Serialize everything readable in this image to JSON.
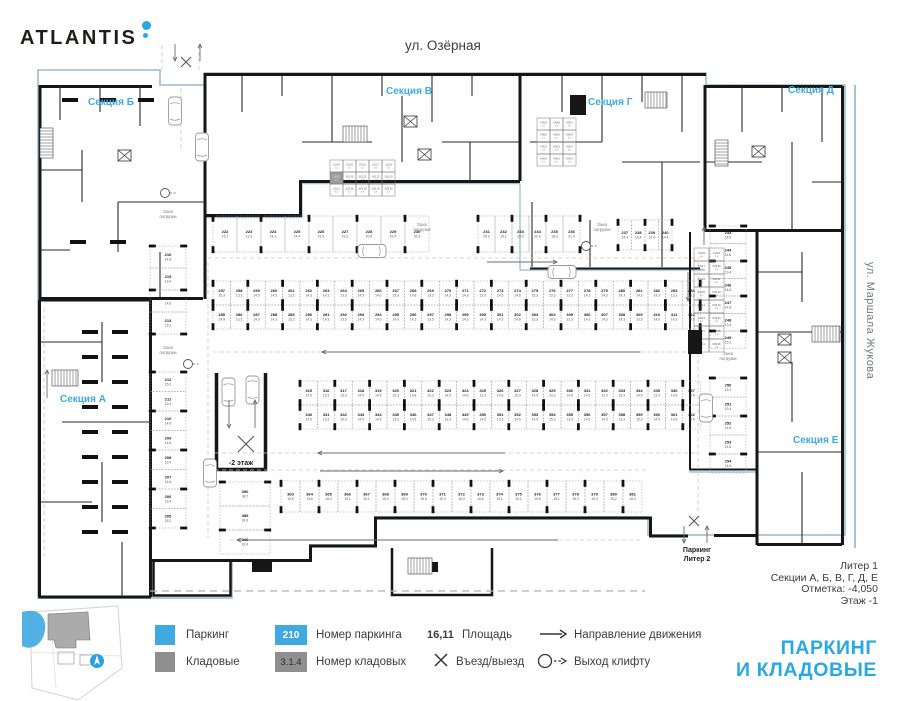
{
  "logo": {
    "text": "ATLANTIS"
  },
  "streets": {
    "top": "ул. Озёрная",
    "right": "ул. Маршала Жукова"
  },
  "sections": {
    "a": "Секция А",
    "b": "Секция Б",
    "v": "Секция В",
    "g": "Секция Г",
    "d": "Секция Д",
    "e": "Секция Е"
  },
  "info": {
    "lines": [
      "Литер 1",
      "Секции А, Б, В, Г, Д, Е",
      "Отметка: -4,050",
      "Этаж -1"
    ]
  },
  "main_title": {
    "line1": "ПАРКИНГ",
    "line2": "И КЛАДОВЫЕ"
  },
  "legend": {
    "parking": "Паркинг",
    "storage": "Кладовые",
    "pnum_value": "210",
    "pnum_label": "Номер паркинга",
    "snum_value": "3.1.4",
    "snum_label": "Номер кладовых",
    "area_value": "16,11",
    "area_label": "Площадь",
    "entry_label": "Въезд/выезд",
    "direction_label": "Направление движения",
    "lift_label": "Выход клифту"
  },
  "colors": {
    "accent": "#29a8e4",
    "legend_blue": "#3fa9e0",
    "legend_gray": "#8f8f8f",
    "wall": "#161616",
    "boundary_blue": "#a7c2d6"
  },
  "plan": {
    "zone_label": "Зона погрузки",
    "ramp_label": "-2 этаж",
    "exit2_lines": [
      "Паркинг",
      "Литер 2"
    ],
    "bands": [
      {
        "x": 213,
        "y": 216,
        "w": 24,
        "h": 36,
        "nums": [
          "222",
          "223",
          "224",
          "225",
          "226",
          "227",
          "228",
          "229",
          "230"
        ],
        "areas": [
          "15.1",
          "13.3",
          "14.1",
          "14.4",
          "21.9",
          "21.0",
          "20.6",
          "22.4",
          "32.3"
        ]
      },
      {
        "x": 478,
        "y": 216,
        "w": 17,
        "h": 36,
        "nums": [
          "231",
          "232",
          "233",
          "234",
          "235",
          "236"
        ],
        "areas": [
          "25.2",
          "19.1",
          "19.0",
          "20.0",
          "18.3",
          "21.4"
        ]
      },
      {
        "x": 618,
        "y": 220,
        "w": 13.5,
        "h": 30,
        "nums": [
          "237",
          "238",
          "239",
          "240"
        ],
        "areas": [
          "14.4",
          "14.4",
          "14.4",
          "14.4"
        ]
      },
      {
        "x": 213,
        "y": 281,
        "w": 17.4,
        "h": 24,
        "nums": [
          "257",
          "258",
          "259",
          "260",
          "261",
          "262",
          "263",
          "264",
          "265",
          "266",
          "267",
          "268",
          "269",
          "270",
          "271",
          "272",
          "273",
          "274",
          "275",
          "276",
          "277",
          "278",
          "279",
          "280",
          "281",
          "282",
          "283",
          "284"
        ],
        "areas": [
          "15.3",
          "13.3",
          "14.5",
          "14.5",
          "13.3",
          "14.3",
          "14.3",
          "13.3",
          "14.5",
          "14.0",
          "15.3",
          "14.8",
          "13.3",
          "14.3",
          "14.3",
          "13.3",
          "14.5",
          "14.5",
          "15.3",
          "13.3",
          "13.3",
          "14.3",
          "14.3",
          "14.3",
          "14.3",
          "14.3",
          "13.3",
          "15.3"
        ]
      },
      {
        "x": 213,
        "y": 305,
        "w": 17.4,
        "h": 24,
        "nums": [
          "285",
          "286",
          "287",
          "288",
          "289",
          "290",
          "291",
          "292",
          "293",
          "294",
          "295",
          "296",
          "297",
          "298",
          "299",
          "300",
          "301",
          "302",
          "303",
          "304",
          "305",
          "306",
          "307",
          "308",
          "309",
          "310",
          "311",
          "312"
        ],
        "areas": [
          "14.9",
          "13.3",
          "14.3",
          "14.3",
          "13.3",
          "14.3",
          "14.3",
          "13.3",
          "14.3",
          "14.0",
          "14.9",
          "14.3",
          "13.3",
          "14.3",
          "14.3",
          "14.3",
          "14.3",
          "14.9",
          "13.3",
          "14.9",
          "13.3",
          "14.3",
          "14.3",
          "14.3",
          "13.3",
          "14.3",
          "14.3",
          "14.9"
        ]
      },
      {
        "x": 300,
        "y": 381,
        "w": 17.4,
        "h": 24,
        "nums": [
          "315",
          "316",
          "317",
          "318",
          "319",
          "320",
          "321",
          "322",
          "323",
          "324",
          "325",
          "326",
          "327",
          "328",
          "329",
          "330",
          "331",
          "332",
          "333",
          "334",
          "335",
          "336",
          "337"
        ],
        "areas": [
          "14.5",
          "15.3",
          "13.3",
          "14.5",
          "14.5",
          "15.3",
          "14.8",
          "13.3",
          "14.5",
          "14.5",
          "13.3",
          "14.5",
          "15.3",
          "14.5",
          "13.3",
          "14.5",
          "14.5",
          "13.3",
          "15.3",
          "14.5",
          "13.3",
          "14.5",
          "14.5"
        ]
      },
      {
        "x": 300,
        "y": 405,
        "w": 17.4,
        "h": 24,
        "nums": [
          "340",
          "341",
          "342",
          "343",
          "344",
          "345",
          "346",
          "347",
          "348",
          "349",
          "350",
          "351",
          "352",
          "353",
          "354",
          "355",
          "356",
          "357",
          "358",
          "359",
          "360",
          "361",
          "362"
        ],
        "areas": [
          "14.5",
          "13.3",
          "15.3",
          "14.5",
          "14.5",
          "13.3",
          "14.5",
          "15.3",
          "13.3",
          "14.5",
          "14.5",
          "13.3",
          "14.5",
          "14.5",
          "15.3",
          "13.3",
          "14.5",
          "14.5",
          "13.3",
          "15.3",
          "14.5",
          "14.5",
          "14.5"
        ]
      },
      {
        "x": 281,
        "y": 481,
        "w": 19,
        "h": 31,
        "nums": [
          "363",
          "364",
          "365",
          "366",
          "367",
          "368",
          "369",
          "370",
          "371",
          "372",
          "373",
          "374",
          "375",
          "376",
          "377",
          "378",
          "379",
          "380",
          "381"
        ],
        "areas": [
          "15.6",
          "13.6",
          "15.2",
          "15.1",
          "15.1",
          "15.4",
          "15.4",
          "15.6",
          "15.3",
          "15.3",
          "15.6",
          "15.1",
          "15.2",
          "15.6",
          "15.1",
          "15.3",
          "15.4",
          "15.2",
          "15.3"
        ]
      }
    ],
    "strips": [
      {
        "x": 150,
        "y": 246,
        "w": 36,
        "h": 22,
        "nums": [
          "216",
          "215",
          "214",
          "213"
        ],
        "areas": [
          "14.6",
          "13.4",
          "14.6",
          "15.2"
        ]
      },
      {
        "x": 150,
        "y": 372,
        "w": 36,
        "h": 19.5,
        "nums": [
          "212",
          "211",
          "210",
          "209",
          "208",
          "207",
          "206",
          "205"
        ],
        "areas": [
          "15.2",
          "13.4",
          "14.6",
          "14.6",
          "13.4",
          "14.6",
          "13.4",
          "15.2"
        ]
      },
      {
        "x": 710,
        "y": 226,
        "w": 36,
        "h": 17.5,
        "nums": [
          "243",
          "244",
          "245",
          "246",
          "247",
          "248",
          "249"
        ],
        "areas": [
          "14.6",
          "14.6",
          "13.4",
          "14.6",
          "14.6",
          "13.4",
          "15.2"
        ]
      },
      {
        "x": 710,
        "y": 378,
        "w": 36,
        "h": 19,
        "nums": [
          "250",
          "251",
          "252",
          "253",
          "254"
        ],
        "areas": [
          "15.2",
          "13.4",
          "14.6",
          "14.6",
          "14.6"
        ]
      },
      {
        "x": 220,
        "y": 482,
        "w": 50,
        "h": 24,
        "nums": [
          "390",
          "389",
          "388"
        ],
        "areas": [
          "38.7",
          "24.9",
          "31.4"
        ]
      }
    ],
    "clusters": [
      {
        "x": 330,
        "y": 160,
        "cols": 5,
        "rows": 3,
        "w": 13,
        "h": 12,
        "filled": [
          5
        ],
        "cells": [
          "3.01.4|5.4",
          "3.01.5|3.7",
          "3.01.6|4.1",
          "3.01.7|5.0",
          "3.01.8|5.0",
          "3.01.2|4.2",
          "3.01.10|5.1",
          "3.01.11|3.8",
          "3.01.12|3.8",
          "3.01.13|5.2",
          "3.01.1|5.4",
          "3.01.16|5.1",
          "3.01.15|3.8",
          "3.01.14|3.8",
          "3.03.10|5.2"
        ]
      },
      {
        "x": 537,
        "y": 118,
        "cols": 3,
        "rows": 4,
        "w": 13,
        "h": 12,
        "filled": [],
        "cells": [
          "4.05.9|5.0",
          "4.05.8|5.0",
          "4.05.7|5.0",
          "4.05.6|3.7",
          "4.05.5|3.7",
          "4.05.4|3.7",
          "4.05.3|3.6",
          "4.05.2|3.7",
          "4.05.1|4.5",
          "4.04.3|3.7",
          "4.04.2|3.7",
          "4.04.1|4.7"
        ]
      },
      {
        "x": 694,
        "y": 248,
        "cols": 2,
        "rows": 8,
        "w": 15,
        "h": 13,
        "filled": [],
        "cells": [
          "6.03.8|4.3",
          "6.03.9|3.6",
          "6.03.7|4.2",
          "6.03.10|3.6",
          "6.03.6|4.2",
          "6.03.11|3.6",
          "6.03.5|4.2",
          "6.03.12|3.6",
          "6.03.4|4.2",
          "6.03.13|3.6",
          "6.03.3|4.2",
          "6.03.14|3.6",
          "6.03.2|4.2",
          "6.03.15|3.6",
          "6.03.1|4.2",
          "6.03.16|3.6"
        ]
      }
    ]
  }
}
